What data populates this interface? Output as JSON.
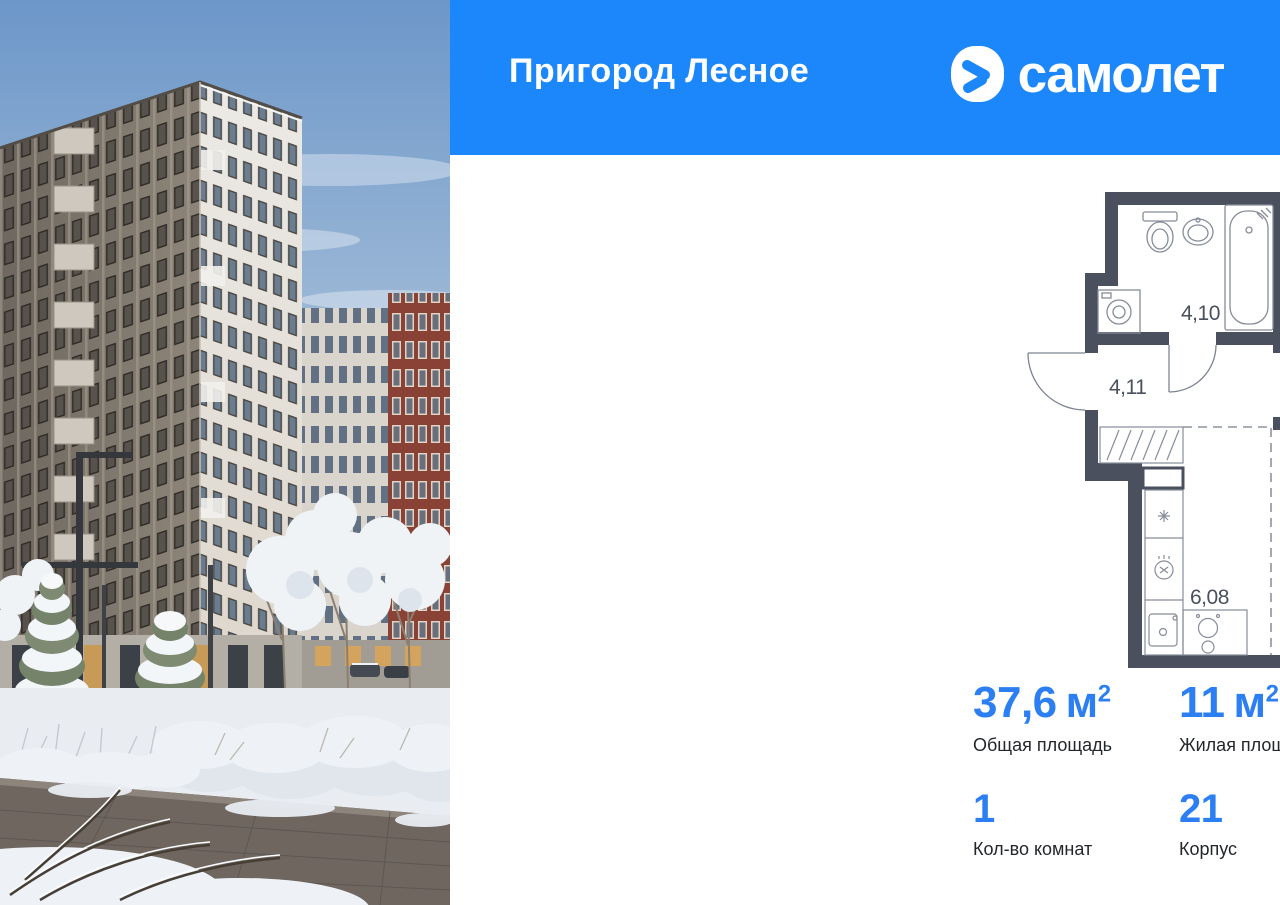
{
  "header": {
    "title": "Пригород Лесное",
    "brand": "самолет"
  },
  "colors": {
    "brand_blue": "#1b87fb",
    "accent_blue": "#2b7ff2",
    "plan_wall": "#4a505e"
  },
  "floor_plan": {
    "labels": {
      "bathroom": "4,10",
      "hallway": "4,11",
      "bedroom": "10,95",
      "living_room": "11,76",
      "kitchen": "6,08",
      "balcony_area": "2,11",
      "balcony_reduced": "(0,63)"
    }
  },
  "stats": {
    "row1": [
      {
        "value": "37,6",
        "unit": "м",
        "sup": "2",
        "label": "Общая площадь"
      },
      {
        "value": "11",
        "unit": "м",
        "sup": "2",
        "label": "Жилая площадь"
      },
      {
        "value": "17,8",
        "unit": "м",
        "sup": "2",
        "label": "Площадь кухни"
      }
    ],
    "row2": [
      {
        "value": "1",
        "label": "Кол-во комнат"
      },
      {
        "value": "21",
        "label": "Корпус"
      },
      {
        "value": "16",
        "label": "Этаж"
      }
    ]
  }
}
